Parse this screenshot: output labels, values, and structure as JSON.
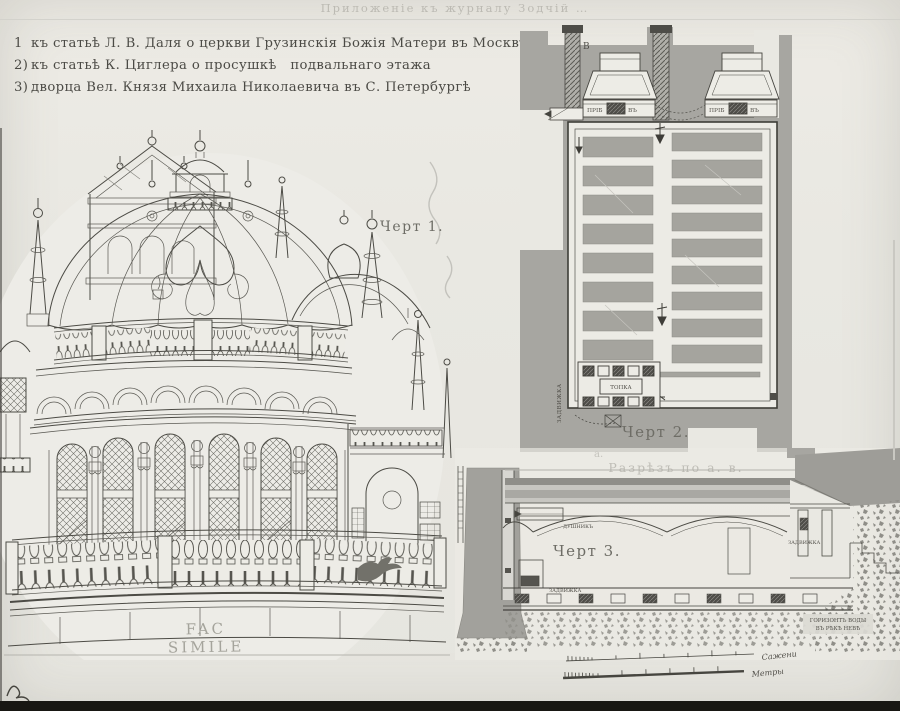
{
  "colors": {
    "paper": "#e9e8e2",
    "wash": "#a7a6a1",
    "ink": "#45443f"
  },
  "masthead": {
    "text": "Приложеніе къ журналу Зодчій …"
  },
  "entries": [
    {
      "num": "1",
      "text": "къ статьѣ Л. В. Даля о церкви Грузинскія Божія Матери въ Москвѣ"
    },
    {
      "num": "2)",
      "text": "къ статьѣ К. Циглера о просушкѣ подвальнаго этажа"
    },
    {
      "num": "3)",
      "text": "дворца Вел. Князя Михаила Николаевича въ С. Петербургѣ"
    }
  ],
  "fig1": {
    "caption": "Черт 1.",
    "facsimile": "FAC SIMILE"
  },
  "fig2": {
    "caption": "Черт 2.",
    "point_b": "В",
    "stove_left_a": "ПРІБ",
    "stove_left_b": "ВЪ",
    "stove_right_a": "ПРІБ",
    "stove_right_b": "ВЪ",
    "damper_vertical": "ЗАДВИЖКА",
    "firebox": "ТОПКА"
  },
  "fig3": {
    "caption": "Черт 3.",
    "title": "Разрѣзъ по а. в.",
    "point_a": "а.",
    "vent": "ДУШНИКЪ",
    "damper_left": "ЗАДВИЖКА",
    "damper_right": "ЗАДВИЖКА",
    "water_level_1": "ГОРИЗОНТЪ ВОДЫ",
    "water_level_2": "ВЪ РѢКѢ НЕВѢ"
  },
  "scales": {
    "top_label": "Сажени",
    "bottom_label": "Метры"
  }
}
